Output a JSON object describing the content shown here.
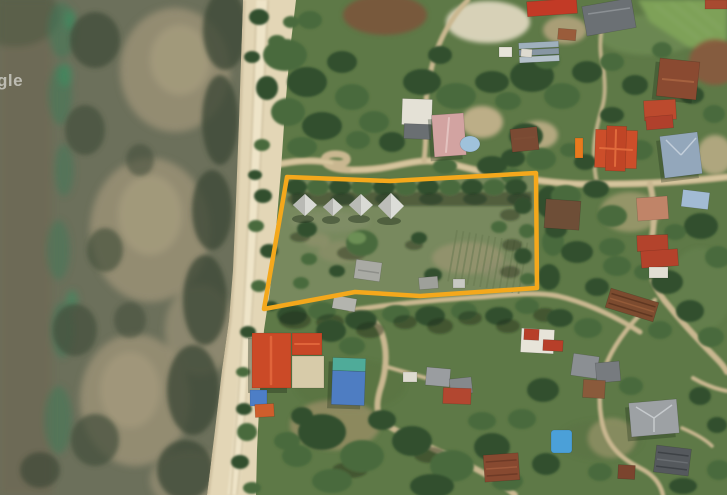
{
  "map": {
    "watermark_text": "gle",
    "parcel": {
      "points": "287,177 390,181 536,173 537,288 420,296 355,292 264,309",
      "stroke_color": "#F4A81C",
      "stroke_width": "4.5"
    },
    "palette": {
      "water": "#6C705B",
      "shallow_sand": "#9A9176",
      "seagrass": "#3E4A37",
      "beach_sand": "#E3D6B6",
      "vegetation": "#5E7947",
      "dirt_road": "#C9B790",
      "parcel_highlight": "#F4A81C"
    }
  }
}
